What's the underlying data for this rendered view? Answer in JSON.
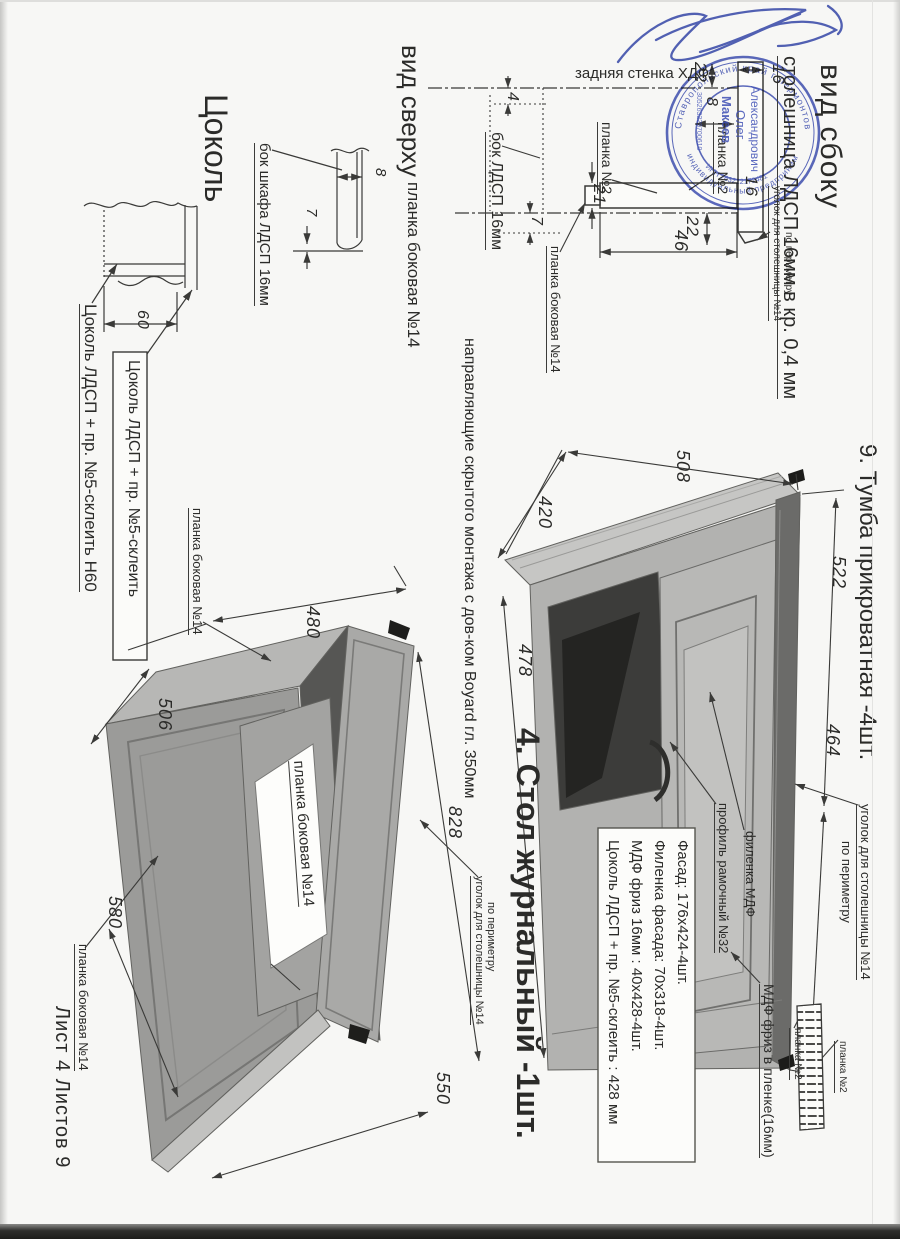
{
  "sheet": {
    "footer": "Лист 4  Листов 9"
  },
  "side_view": {
    "title": "вид сбоку",
    "subtitle": "столешница ЛДСП 16мм в кр. 0,4 мм",
    "back_wall": "задняя стенка ХДФ",
    "plank2_left": "планка №2",
    "plank2_right": "планка №2",
    "corner_note1": "уголок для столешницы  №14",
    "corner_note2": "по периметру",
    "dim_22_top": "22",
    "dim_16_top": "16",
    "dim_8": "8",
    "dim_16_mid": "16",
    "dim_21": "21",
    "dim_22_bot": "22",
    "dim_46": "46"
  },
  "top_view": {
    "title": "вид сверху",
    "subtitle": "планка боковая  №14",
    "side_label": "бок ЛДСП 16мм",
    "plank_label": "планка боковая  №14",
    "dim_4": "4",
    "dim_7": "7"
  },
  "plinth": {
    "title": "Цоколь",
    "side_label": "бок шкафа ЛДСП 16мм",
    "note_glue_h60": "Цоколь ЛДСП + пр. №5-склеить  Н60",
    "note_glue_boxed": "Цоколь ЛДСП + пр. №5-склеить",
    "dim_60": "60",
    "dim_8": "8",
    "dim_7": "7"
  },
  "table": {
    "title": "4. Стол журнальный -1шт.",
    "slides_note": "направляющие скрытого монтажа с дов-ком Boyard гл. 350мм",
    "plank_top": "планка боковая  №14",
    "plank_box": "планка боковая  №14",
    "plank_bottom": "планка боковая  №14",
    "corner_note1": "уголок для столешницы  №14",
    "corner_note2": "по периметру",
    "dim_480": "480",
    "dim_506": "506",
    "dim_828": "828",
    "dim_580": "580",
    "dim_550": "550"
  },
  "cabinet": {
    "title": "9. Тумба прикроватная -4шт.",
    "dim_508": "508",
    "dim_420": "420",
    "dim_478": "478",
    "dim_522": "522",
    "dim_464": "464",
    "label_profile": "профиль рамочный №32",
    "label_panel": "филенка МДФ",
    "corner_note1": "уголок для столешницы  №14",
    "corner_note2": "по периметру",
    "label_frieze": "МДФ фриз в пленке(16мм)",
    "plank2_a": "планка №2",
    "plank2_b": "планка №2",
    "specs": [
      "Фасад: 176х424-4шт.",
      "Филенка фасада: 70х318-4шт.",
      "МДФ фриз 16мм : 40х428-4шт.",
      "Цоколь ЛДСП + пр. №5-склеить : 428 мм"
    ]
  },
  "stamp": {
    "ring_top": "Ставропольский край г.Лермонтов",
    "ring_bottom": "индивидуальный предприниматель",
    "ring_inner": "ИНН 263212172481",
    "ogrn": "305263229700610",
    "name1": "Макеев",
    "name2": "Олег",
    "name3": "Александрович"
  },
  "colors": {
    "stamp_blue": "#3f50b5",
    "ink_blue": "#3547ad",
    "line": "#3a3a38"
  }
}
